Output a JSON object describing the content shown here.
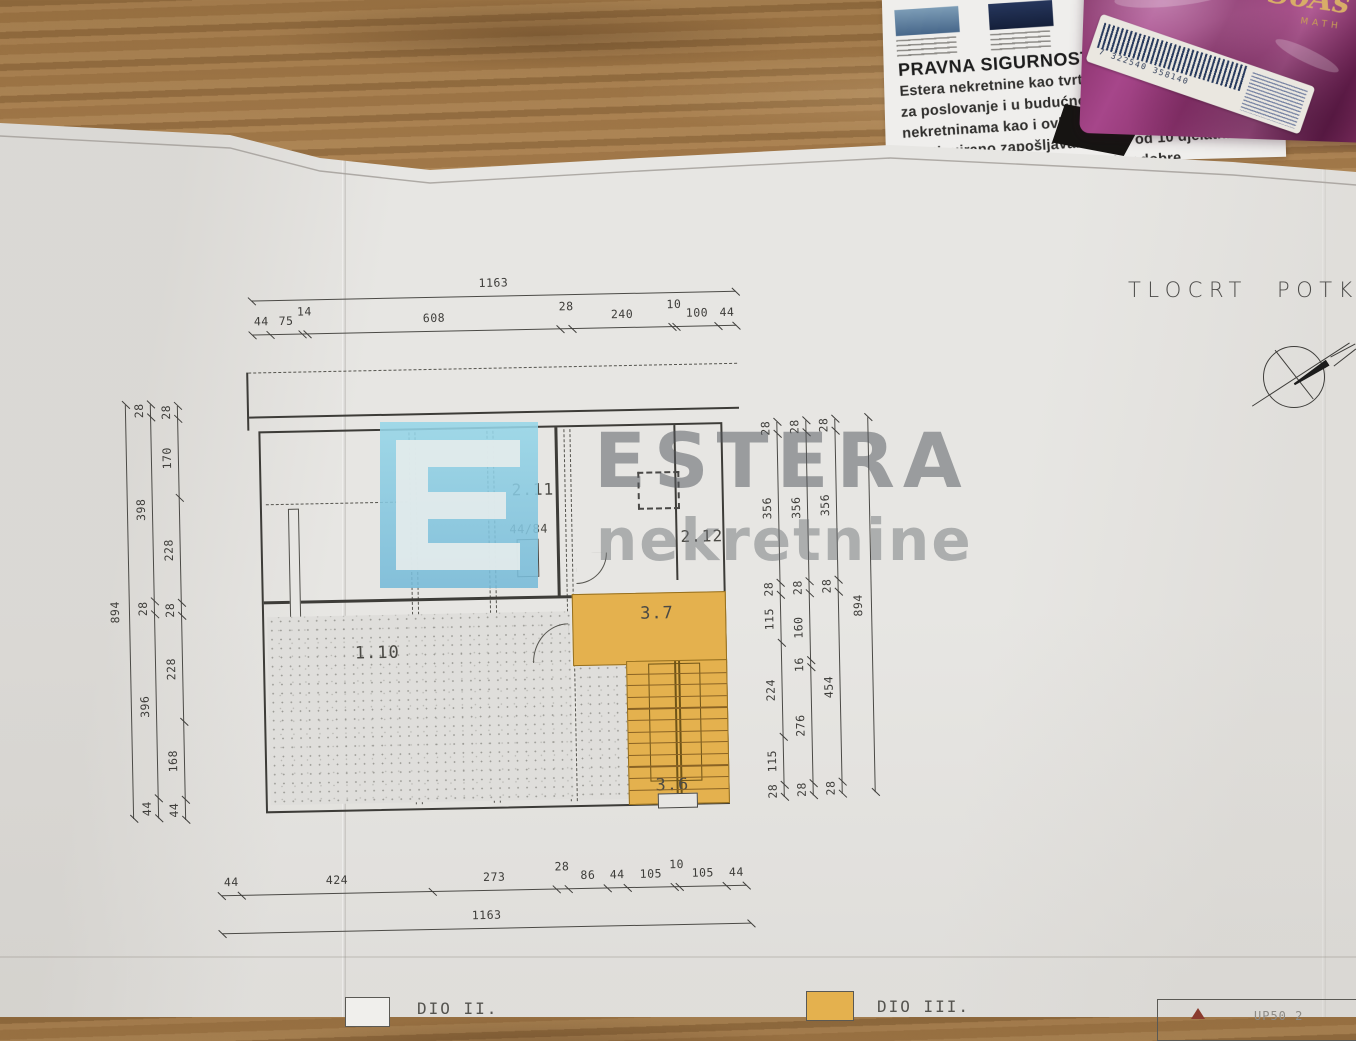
{
  "clipping": {
    "heading": "PRAVNA SIGURNOST",
    "body_lines": [
      "Estera nekretnine kao tvrtka posluj",
      "za poslovanje i u budućnosti. Tvrtka po",
      "nekretninama kao i ovlašteni posrednik za po",
      "Kontinuirano zapošljavamo više od 10 djelatni",
      "slenicima i regulatori        potvrđuju odobre"
    ]
  },
  "package": {
    "script_text": "SoAs",
    "gold_subtext": "MATH",
    "barcode_number": "7 322540 358140"
  },
  "drawing": {
    "title": "TLOCRT POTKROVLJ",
    "watermark": {
      "brand": "ESTERA",
      "sub": "nekretnine"
    },
    "rooms": {
      "r211": "2.11",
      "r212": "2.12",
      "r110": "1.10",
      "r37": "3.7",
      "r36": "3.6",
      "window": "44/84"
    },
    "dims": {
      "top": {
        "total": "1163",
        "segments": [
          "44",
          "75",
          "14",
          "608",
          "28",
          "240",
          "10",
          "100",
          "44"
        ]
      },
      "bottom": {
        "total": "1163",
        "segments": [
          "44",
          "424",
          "273",
          "28",
          "86",
          "44",
          "105",
          "10",
          "105",
          "44"
        ]
      },
      "left": {
        "total": "894",
        "chainB": [
          "28",
          "398",
          "28",
          "396",
          "44"
        ],
        "chainC": [
          "28",
          "170",
          "228",
          "28",
          "228",
          "168",
          "44"
        ]
      },
      "right": {
        "total": "894",
        "chain1": [
          "28",
          "356",
          "28",
          "115",
          "224",
          "115",
          "28"
        ],
        "chain2": [
          "28",
          "356",
          "28",
          "160",
          "16",
          "276",
          "28"
        ],
        "chain3": [
          "28",
          "356",
          "28",
          "454",
          "28"
        ]
      }
    },
    "legend": [
      {
        "label": "DIO II.",
        "swatch": "#f0efec"
      },
      {
        "label": "DIO III.",
        "swatch": "#e4b14e"
      }
    ],
    "corner_box_text": "UP50 2"
  },
  "colors": {
    "accent_yellow": "#e4b14e",
    "logo_blue": "#8fd0e4",
    "wood": "#ac8050",
    "paper": "#e7e6e3"
  }
}
